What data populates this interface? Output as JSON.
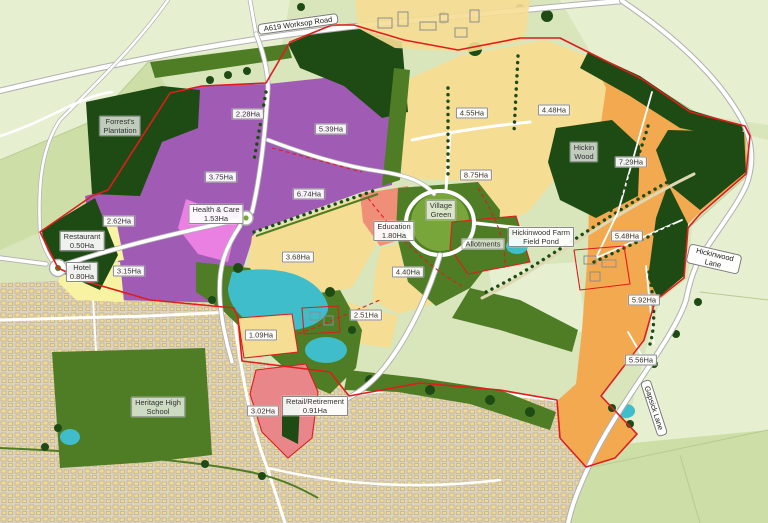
{
  "palette": {
    "bg": "#d9e5bb",
    "field_light": "#e6efcf",
    "field_mid": "#cddfa7",
    "wood_dark": "#1e4b14",
    "green_mid": "#4e7d26",
    "green_light": "#79a63a",
    "purple": "#a05cb5",
    "pink": "#ea80e2",
    "yellow": "#f6dd94",
    "pale_yellow": "#f8f3a3",
    "orange": "#f3a94f",
    "salmon": "#ef8f78",
    "red_parcel": "#e8868a",
    "teal": "#3fbdca",
    "boundary": "#e01c1c",
    "road_casing": "#b0b0b0",
    "urban_bg": "#ddd2ba",
    "urban_building": "#f2db90",
    "urban_line": "#a89e8e"
  },
  "map": {
    "type": "masterplan-land-use-map",
    "labels": [
      {
        "id": "a619-worksop-road",
        "kind": "road",
        "text": "A619 Worksop Road",
        "x": 298,
        "y": 24,
        "rot": -8
      },
      {
        "id": "forrests-plantation",
        "kind": "place",
        "text": "Forrest's\nPlantation",
        "x": 120,
        "y": 126,
        "rot": 0
      },
      {
        "id": "parcel-2-28",
        "kind": "area",
        "text": "2.28Ha",
        "x": 248,
        "y": 114,
        "rot": 0
      },
      {
        "id": "parcel-5-39",
        "kind": "area",
        "text": "5.39Ha",
        "x": 331,
        "y": 129,
        "rot": 0
      },
      {
        "id": "parcel-3-75",
        "kind": "area",
        "text": "3.75Ha",
        "x": 221,
        "y": 177,
        "rot": 0
      },
      {
        "id": "parcel-6-74",
        "kind": "area",
        "text": "6.74Ha",
        "x": 309,
        "y": 194,
        "rot": 0
      },
      {
        "id": "parcel-2-62",
        "kind": "area",
        "text": "2.62Ha",
        "x": 119,
        "y": 221,
        "rot": 0
      },
      {
        "id": "restaurant",
        "kind": "area",
        "text": "Restaurant\n0.50Ha",
        "x": 82,
        "y": 241,
        "rot": 0
      },
      {
        "id": "hotel",
        "kind": "area",
        "text": "Hotel\n0.80Ha",
        "x": 82,
        "y": 272,
        "rot": 0
      },
      {
        "id": "parcel-3-15",
        "kind": "area",
        "text": "3.15Ha",
        "x": 129,
        "y": 271,
        "rot": 0
      },
      {
        "id": "health-care",
        "kind": "area",
        "text": "Health & Care\n1.53Ha",
        "x": 216,
        "y": 214,
        "rot": 0
      },
      {
        "id": "parcel-3-68",
        "kind": "area",
        "text": "3.68Ha",
        "x": 298,
        "y": 257,
        "rot": 0
      },
      {
        "id": "education",
        "kind": "area",
        "text": "Education\n1.80Ha",
        "x": 394,
        "y": 231,
        "rot": 0
      },
      {
        "id": "village-green",
        "kind": "place",
        "text": "Village\nGreen",
        "x": 441,
        "y": 210,
        "rot": 0
      },
      {
        "id": "parcel-4-40",
        "kind": "area",
        "text": "4.40Ha",
        "x": 408,
        "y": 272,
        "rot": 0
      },
      {
        "id": "parcel-2-51",
        "kind": "area",
        "text": "2.51Ha",
        "x": 366,
        "y": 315,
        "rot": 0
      },
      {
        "id": "parcel-4-55",
        "kind": "area",
        "text": "4.55Ha",
        "x": 472,
        "y": 113,
        "rot": 0
      },
      {
        "id": "parcel-4-48",
        "kind": "area",
        "text": "4.48Ha",
        "x": 554,
        "y": 110,
        "rot": 0
      },
      {
        "id": "parcel-8-75",
        "kind": "area",
        "text": "8.75Ha",
        "x": 476,
        "y": 175,
        "rot": 0
      },
      {
        "id": "hickin-wood",
        "kind": "place",
        "text": "Hickin\nWood",
        "x": 584,
        "y": 152,
        "rot": 0
      },
      {
        "id": "allotments",
        "kind": "place",
        "text": "Allotments",
        "x": 483,
        "y": 244,
        "rot": 0
      },
      {
        "id": "hickinwood-farm-field-pond",
        "kind": "area",
        "text": "Hickinwood Farm\nField Pond",
        "x": 541,
        "y": 237,
        "rot": 0
      },
      {
        "id": "parcel-7-29",
        "kind": "area",
        "text": "7.29Ha",
        "x": 631,
        "y": 162,
        "rot": 0
      },
      {
        "id": "parcel-5-48",
        "kind": "area",
        "text": "5.48Ha",
        "x": 627,
        "y": 236,
        "rot": 0
      },
      {
        "id": "parcel-5-92",
        "kind": "area",
        "text": "5.92Ha",
        "x": 644,
        "y": 300,
        "rot": 0
      },
      {
        "id": "parcel-5-56",
        "kind": "area",
        "text": "5.56Ha",
        "x": 641,
        "y": 360,
        "rot": 0
      },
      {
        "id": "parcel-1-09",
        "kind": "area",
        "text": "1.09Ha",
        "x": 261,
        "y": 335,
        "rot": 0
      },
      {
        "id": "parcel-3-02",
        "kind": "area",
        "text": "3.02Ha",
        "x": 263,
        "y": 411,
        "rot": 0
      },
      {
        "id": "retail-retirement",
        "kind": "area",
        "text": "Retail/Retirement\n0.91Ha",
        "x": 315,
        "y": 406,
        "rot": 0
      },
      {
        "id": "heritage-high-school",
        "kind": "place",
        "text": "Heritage High\nSchool",
        "x": 158,
        "y": 407,
        "rot": 0
      },
      {
        "id": "hickinwood-lane",
        "kind": "road",
        "text": "Hickinwood Lane",
        "x": 714,
        "y": 259,
        "rot": 13
      },
      {
        "id": "gapsick-lane",
        "kind": "road",
        "text": "Gapsick Lane",
        "x": 654,
        "y": 408,
        "rot": 72
      }
    ]
  }
}
